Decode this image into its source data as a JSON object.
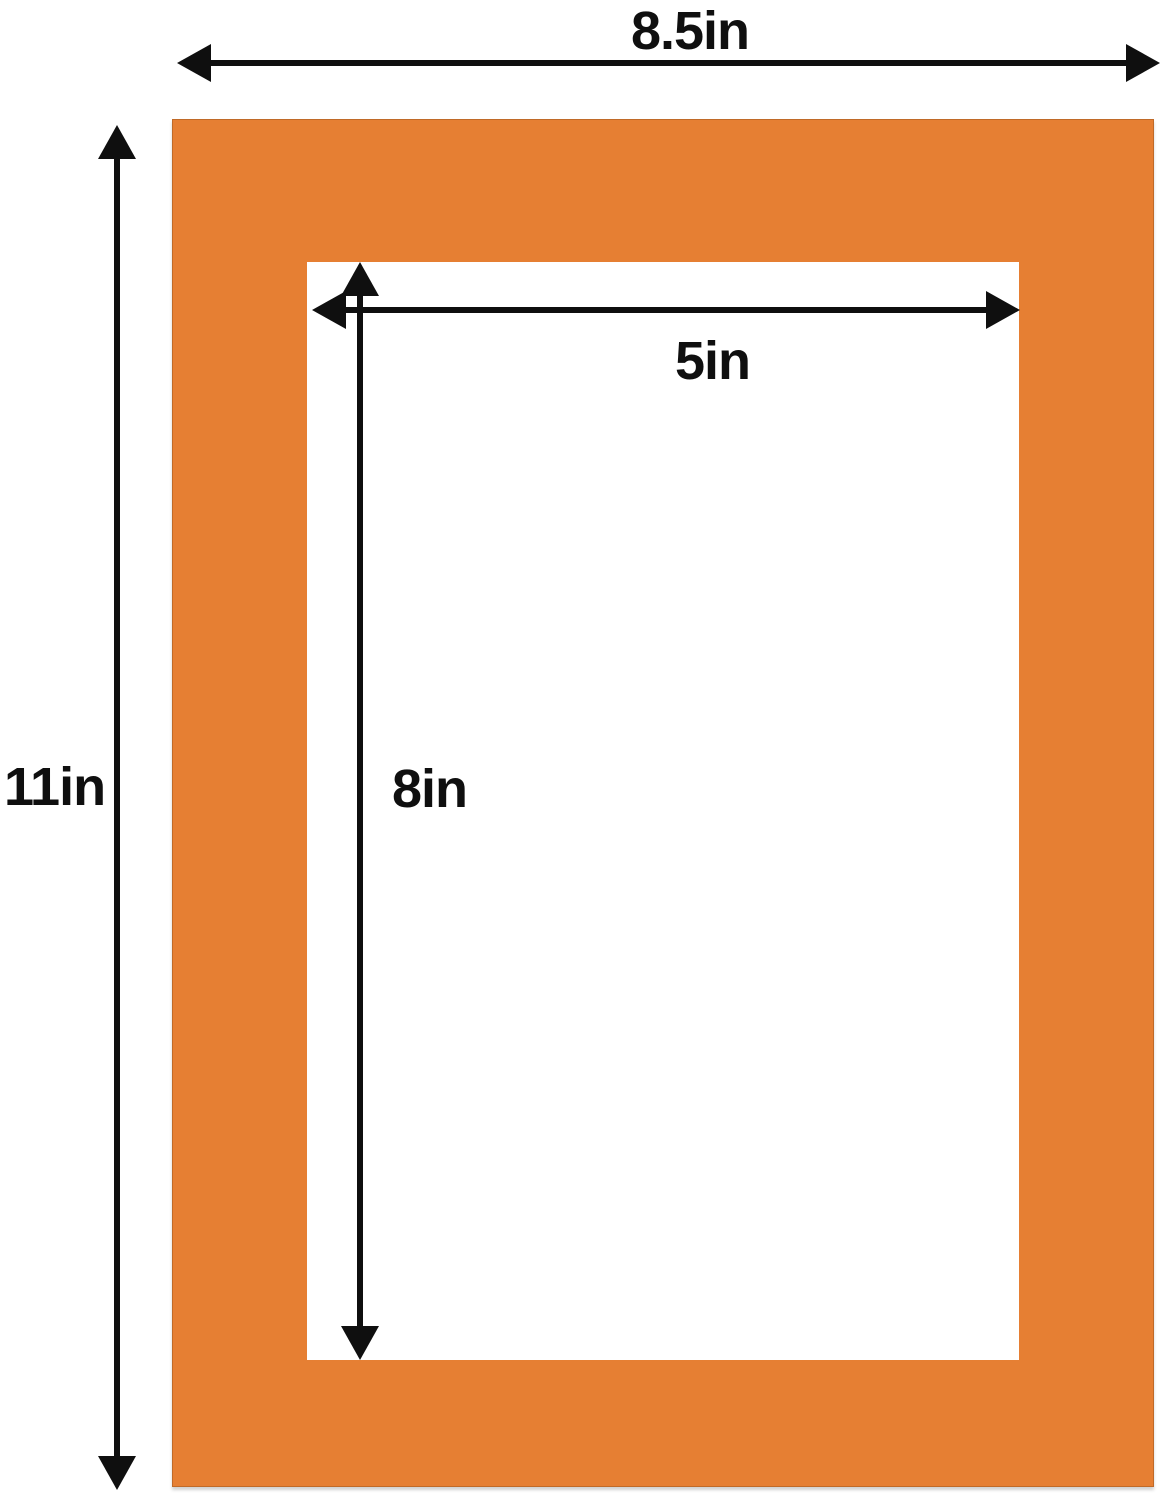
{
  "diagram": {
    "outer_width": {
      "label": "8.5in"
    },
    "outer_height": {
      "label": "11in"
    },
    "opening_width": {
      "label": "5in"
    },
    "opening_height": {
      "label": "8in"
    },
    "colors": {
      "mat_orange": "#E67F33",
      "ink_black": "#0f0f0f",
      "background_white": "#ffffff"
    }
  }
}
